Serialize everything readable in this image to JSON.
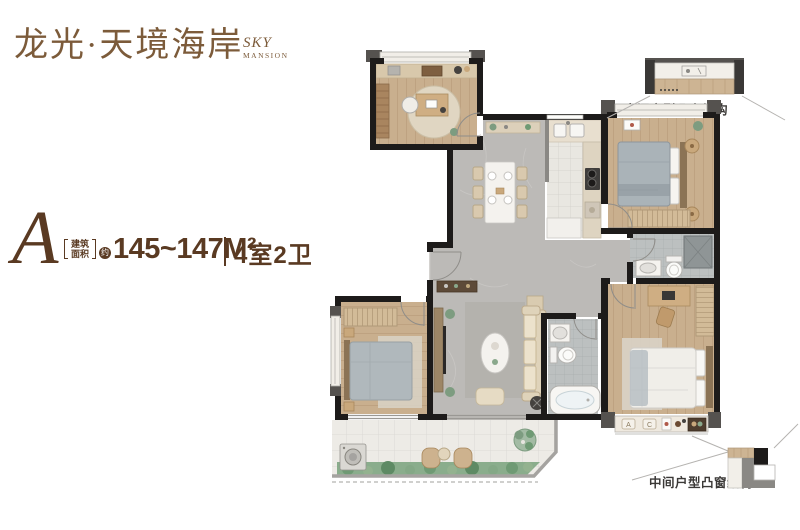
{
  "brand": {
    "logo": "龙光·天境海岸",
    "sub1": "SKY",
    "sub2": "MANSION",
    "color": "#7c5b3a"
  },
  "unit": {
    "letter": "A",
    "area_bracket_top": "建筑",
    "area_bracket_bottom": "面积",
    "area_circle": "约",
    "area_value": "145~147M²",
    "rooms": "4室2卫",
    "text_color": "#5a3a22"
  },
  "callouts": {
    "top_label": "中间户型凸窗结构",
    "bottom_label": "中间户型凸窗结构",
    "text_color": "#3b3937"
  },
  "plan": {
    "cushions": [
      "A",
      "C"
    ],
    "colors": {
      "wall": "#1d1b1a",
      "wall_gray": "#55524f",
      "wood": "#c9af8e",
      "marble": "#bcbab7",
      "tile": "#e9e7e1",
      "bath_tile": "#bcc0c0",
      "wardrobe": "#d2bb98",
      "balcony": "#edebe6",
      "greenery": "#8aad8c",
      "sofa": "#dfd3ba"
    }
  }
}
